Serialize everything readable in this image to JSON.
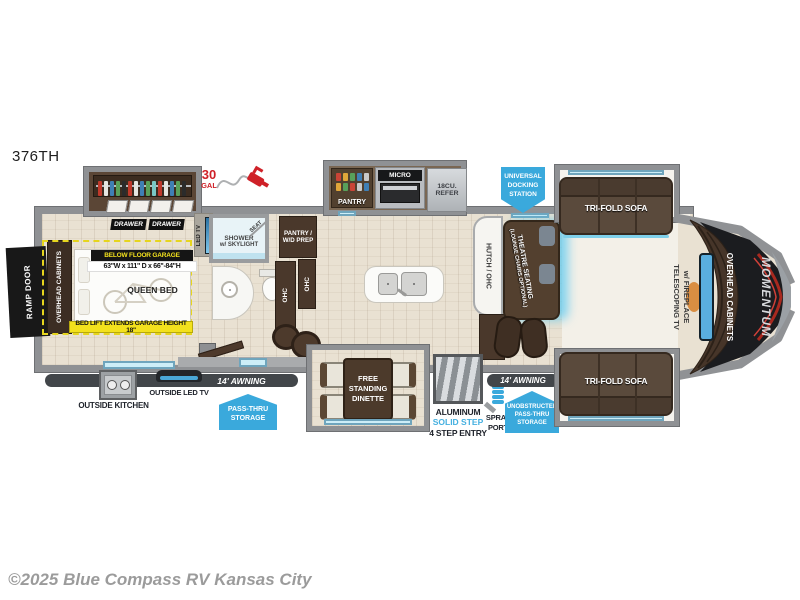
{
  "page": {
    "model": "376TH",
    "copyright": "©2025 Blue Compass RV Kansas City"
  },
  "colors": {
    "badge_blue": "#3aa9dc",
    "highlight_yellow": "#f3e11d",
    "accent_red": "#cf2128",
    "wall_gray": "#8f9194",
    "furniture_brown": "#4a382b"
  },
  "garage": {
    "ramp_door": "RAMP DOOR",
    "overhead_cabinets": "OVERHEAD CABINETS",
    "below_floor_garage": "BELOW FLOOR GARAGE",
    "garage_dims": "63\"W x 111\" D x 66\"-84\"H",
    "queen_bed": "QUEEN BED",
    "bed_lift": "BED LIFT EXTENDS GARAGE HEIGHT 18\"",
    "drawer": "DRAWER",
    "led_tv": "LED TV",
    "fuel_qty": "30",
    "fuel_unit": "GAL"
  },
  "bath": {
    "shower_line1": "SHOWER",
    "shower_line2": "w/ SKYLIGHT",
    "seat": "SEAT",
    "pantry_wd_line1": "PANTRY /",
    "pantry_wd_line2": "W/D PREP",
    "ohc": "OHC"
  },
  "kitchen": {
    "pantry": "PANTRY",
    "micro": "MICRO",
    "refer_line1": "18CU.",
    "refer_line2": "REFER"
  },
  "living": {
    "hutch": "HUTCH / OHC",
    "theatre_line1": "THEATRE SEATING",
    "theatre_line2": "(LOUNGE CHAIRS OPTIONAL)",
    "trifold_sofa": "TRI-FOLD SOFA",
    "tv_line1": "TELESCOPING TV",
    "tv_line2": "w/ FIREPLACE",
    "cap_overhead_cabinets": "OVERHEAD CABINETS",
    "brand": "MOMENTUM"
  },
  "badges": {
    "docking": [
      "UNIVERSAL",
      "DOCKING",
      "STATION"
    ],
    "passthru": [
      "PASS-THRU",
      "STORAGE"
    ],
    "unobstructed": [
      "UNOBSTRUCTED",
      "PASS-THRU",
      "STORAGE"
    ]
  },
  "exterior": {
    "awning": "14' AWNING",
    "outside_kitchen": "OUTSIDE KITCHEN",
    "outside_led_tv": "OUTSIDE LED TV",
    "dinette": [
      "FREE",
      "STANDING",
      "DINETTE"
    ],
    "steps_line1": "ALUMINUM",
    "steps_line2": "SOLID STEP",
    "steps_line3": "4 STEP ENTRY",
    "spray_line1": "SPRAY",
    "spray_line2": "PORT"
  }
}
